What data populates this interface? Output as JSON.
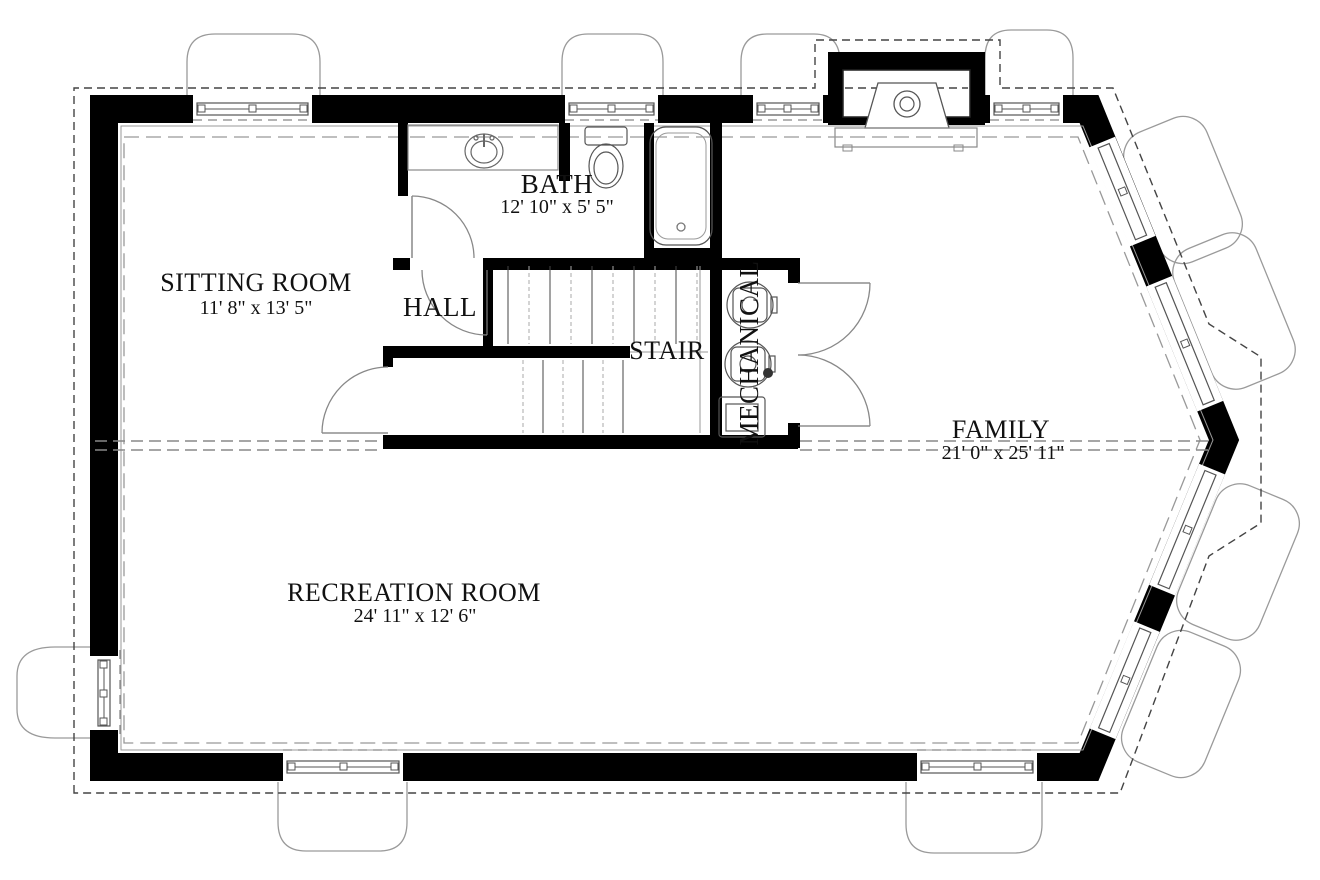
{
  "rooms": {
    "sitting": {
      "label": "SITTING ROOM",
      "dims": "11' 8\" x 13' 5\""
    },
    "bath": {
      "label": "BATH",
      "dims": "12' 10\" x 5' 5\""
    },
    "hall": {
      "label": "HALL"
    },
    "stair": {
      "label": "STAIR"
    },
    "mechanical": {
      "label": "MECHANICAL"
    },
    "family": {
      "label": "FAMILY",
      "dims": "21' 0\" x 25' 11\""
    },
    "recreation": {
      "label": "RECREATION ROOM",
      "dims": "24' 11\" x 12' 6\""
    }
  },
  "colors": {
    "wall": "#000000",
    "thin_line": "#555555",
    "dashed_outline": "#444444",
    "overhang_dash": "#999999",
    "well_line": "#9a9a9a"
  }
}
